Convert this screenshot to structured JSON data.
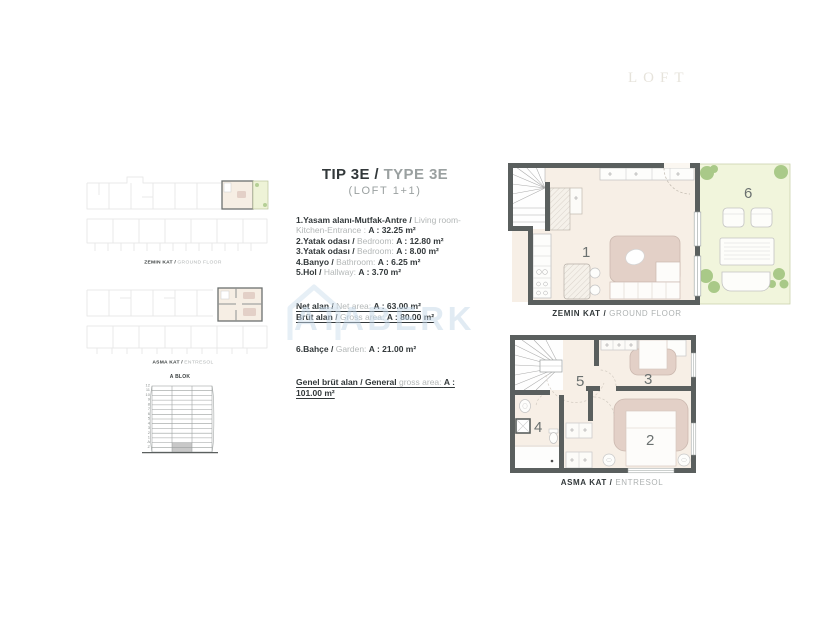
{
  "colors": {
    "wall": "#5a5f5e",
    "floor_cream": "#f7efe6",
    "furniture_beige": "#e3d0c7",
    "garden_green": "#f1f5dc",
    "tree_green": "#a2c57f",
    "text_dark": "#32383a",
    "text_gray": "#b3b7b7",
    "watermark_blue": "#c5d8e9",
    "elevation_highlight_gray": "#c8c8c8"
  },
  "logo": {
    "text": "LOFT"
  },
  "watermark": {
    "text": "ATABERK"
  },
  "overview": {
    "ground": {
      "label_tr": "ZEMIN KAT /",
      "label_en": "GROUND FLOOR"
    },
    "entresol": {
      "label_tr": "ASMA KAT /",
      "label_en": "ENTRESOL"
    }
  },
  "elevation": {
    "title": "A BLOK",
    "floors_text": "12\n11\n10\n9\n8\n7\n6\n5\n4\n3\n2\n1\nA\nZ"
  },
  "unit": {
    "title_tr": "TIP 3E /",
    "title_en": "TYPE 3E",
    "subtitle": "(LOFT 1+1)",
    "rooms": [
      {
        "tr": "1.Yasam alanı-Mutfak-Antre /",
        "en": "Living room-Kitchen-Entrance :",
        "area": "A : 32.25 m²"
      },
      {
        "tr": "2.Yatak odası /",
        "en": "Bedroom:",
        "area": "A : 12.80 m²"
      },
      {
        "tr": "3.Yatak odası /",
        "en": "Bedroom:",
        "area": "A : 8.00 m²"
      },
      {
        "tr": "4.Banyo /",
        "en": "Bathroom:",
        "area": "A : 6.25 m²"
      },
      {
        "tr": "5.Hol /",
        "en": "Hallway:",
        "area": "A : 3.70 m²"
      }
    ],
    "summary": {
      "net": {
        "tr": "Net alan /",
        "en": "Net area:",
        "area": "A : 63.00 m²"
      },
      "gross": {
        "tr": "Brüt alan /",
        "en": "Gross area:",
        "area": "A : 80.00 m²"
      },
      "garden": {
        "tr": "6.Bahçe /",
        "en": "Garden:",
        "area": "A : 21.00 m²"
      },
      "general": {
        "tr": "Genel brüt alan / General",
        "en": "gross area:",
        "area": "A : 101.00 m²"
      }
    }
  },
  "plans": {
    "ground": {
      "label_tr": "ZEMIN KAT /",
      "label_en": "GROUND FLOOR",
      "room_numbers": {
        "living": "1",
        "garden": "6"
      }
    },
    "entresol": {
      "label_tr": "ASMA KAT /",
      "label_en": "ENTRESOL",
      "room_numbers": {
        "hall": "5",
        "bedroom3": "3",
        "bathroom": "4",
        "bedroom2": "2"
      }
    }
  }
}
